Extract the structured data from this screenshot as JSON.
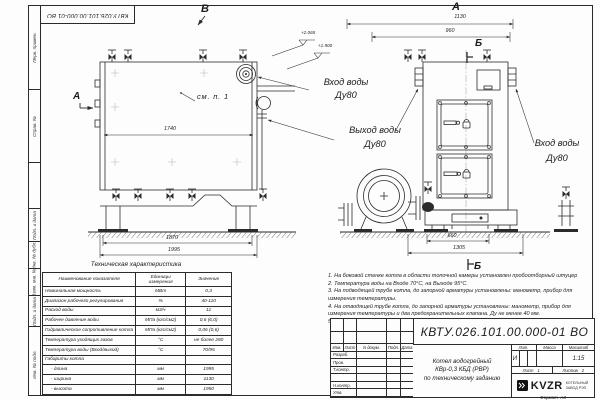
{
  "doc": {
    "number": "КВТУ.026.101.00.000-01 ВО",
    "format_label": "Формат",
    "format_value": "А3"
  },
  "frame_labels": {
    "perv": "Перв. примен.",
    "sprav": "Справ. №",
    "pd1": "Подп. и дата",
    "dubl": "Инв. № дубл.",
    "vzam": "Взам. инв. №",
    "pd2": "Подп. и дата",
    "podl": "Инв. № подл."
  },
  "views": {
    "side": {
      "marker_top": "В",
      "marker_side": "А",
      "see_note": "см. п. 1",
      "dim_inner": "1740",
      "dim_frame": "1870",
      "dim_total": "1995",
      "elev_upper": "+2.065",
      "elev_lower": "+1.900",
      "inlet_line1": "Вход воды",
      "inlet_line2": "Ду80"
    },
    "front": {
      "marker_top": "А",
      "section_top": "Б",
      "section_bottom": "Б",
      "dim_total": "1130",
      "dim_inner": "960",
      "dim_base_inner": "660",
      "dim_base_total": "1305",
      "outlet_line1": "Выход воды",
      "outlet_line2": "Ду80",
      "inlet_line1": "Вход воды",
      "inlet_line2": "Ду80"
    }
  },
  "spec_table": {
    "title": "Техническая характеристика",
    "col_param": "Наименование показателя",
    "col_units_1": "Единицы",
    "col_units_2": "измерения",
    "col_value": "Значение",
    "rows": [
      [
        "Номинальная мощность",
        "МВт",
        "0,3"
      ],
      [
        "Диапазон рабочего регулирования",
        "%",
        "40-110"
      ],
      [
        "Расход воды",
        "м3/ч",
        "11"
      ],
      [
        "Рабочее давление воды",
        "МПа (кгс/см2)",
        "0,6 (6,0)"
      ],
      [
        "Гидравлическое сопротивление котла",
        "МПа (кгс/см2)",
        "0,06 (0,6)"
      ],
      [
        "Температура уходящих газов",
        "°С",
        "не более 280"
      ],
      [
        "Температура воды (Вход/выход)",
        "°С",
        "70/95"
      ],
      [
        "Габариты котла",
        "",
        ""
      ],
      [
        "- длина",
        "мм",
        "1995"
      ],
      [
        "- ширина",
        "мм",
        "1130"
      ],
      [
        "- высота",
        "мм",
        "1950"
      ]
    ]
  },
  "notes": [
    "1.  На боковой стенке котла в области топочной камеры установлен пробоотборный штуцер",
    "2.  Температура воды на Входе 70°С, на Выходе 95°С.",
    "3.  На подводящей трубе котла, до запорной арматуры установлены: манометр, прибор для измерения температуры.",
    "4.  На отводящей трубе котла, до запорной арматуры установлены: манометр, прибор для измерения температуры и два предохранительных клапана. Ду не менее 40 мм.",
    "5.  Остальные технические требования по ОСТ 108.030.133-84."
  ],
  "title_block": {
    "rev_cols": {
      "izm": "Изм.",
      "list": "Лист",
      "doc": "N докум.",
      "podp": "Подп.",
      "data": "Дата"
    },
    "roles": {
      "r1": "Разраб.",
      "r2": "Пров.",
      "r3": "Т.контр.",
      "r4": "",
      "r5": "Н.контр.",
      "r6": "Утв."
    },
    "product_line1": "Котел водогрейный",
    "product_line2": "КВр-0,3 КБД (РВР)",
    "product_line3": "по техническому заданию",
    "lit_label": "Лит.",
    "lit_value": "И",
    "mass_label": "Масса",
    "scale_label": "Масштаб",
    "scale_value": "1:15",
    "sheet_label": "Лист",
    "sheet_value": "1",
    "sheets_label": "Листов",
    "sheets_value": "2",
    "company_abbr": "KVZR",
    "company_line1": "КОТЕЛЬНЫЙ",
    "company_line2": "ЗАВОД РЭП"
  }
}
